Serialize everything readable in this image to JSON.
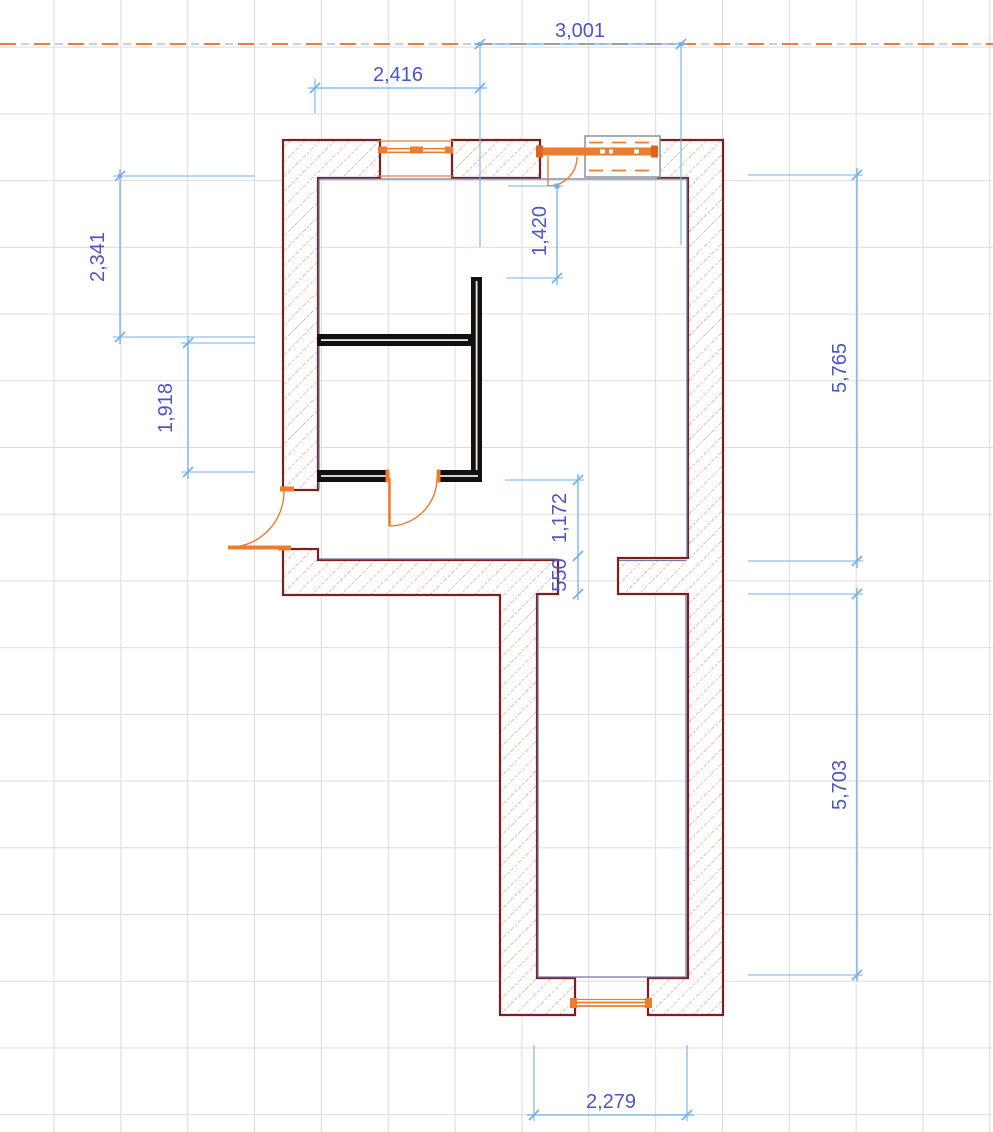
{
  "drawing": {
    "title": "floor-plan",
    "grid_spacing_px": 66.8,
    "colors": {
      "grid": "#dcdcdc",
      "wall_outline": "#7c1f1f",
      "wall_hatch": "#e06a52",
      "inner_face": "#6b7ba8",
      "partition": "#111111",
      "fixture_orange": "#ee7c2c",
      "fixture_box_outline": "#909090",
      "reference_line": "#ee7c3c",
      "dimension_line": "#72b0ec",
      "dimension_text": "#4b55c8"
    },
    "dimensions": {
      "d3001": {
        "label": "3,001",
        "orientation": "horizontal"
      },
      "d2416": {
        "label": "2,416",
        "orientation": "horizontal"
      },
      "d2341": {
        "label": "2,341",
        "orientation": "vertical"
      },
      "d1918": {
        "label": "1,918",
        "orientation": "vertical"
      },
      "d1420": {
        "label": "1,420",
        "orientation": "vertical"
      },
      "d5765": {
        "label": "5,765",
        "orientation": "vertical"
      },
      "d1172": {
        "label": "1,172",
        "orientation": "vertical"
      },
      "d550": {
        "label": "550",
        "orientation": "vertical"
      },
      "d5703": {
        "label": "5,703",
        "orientation": "vertical"
      },
      "d2279": {
        "label": "2,279",
        "orientation": "horizontal"
      }
    }
  }
}
